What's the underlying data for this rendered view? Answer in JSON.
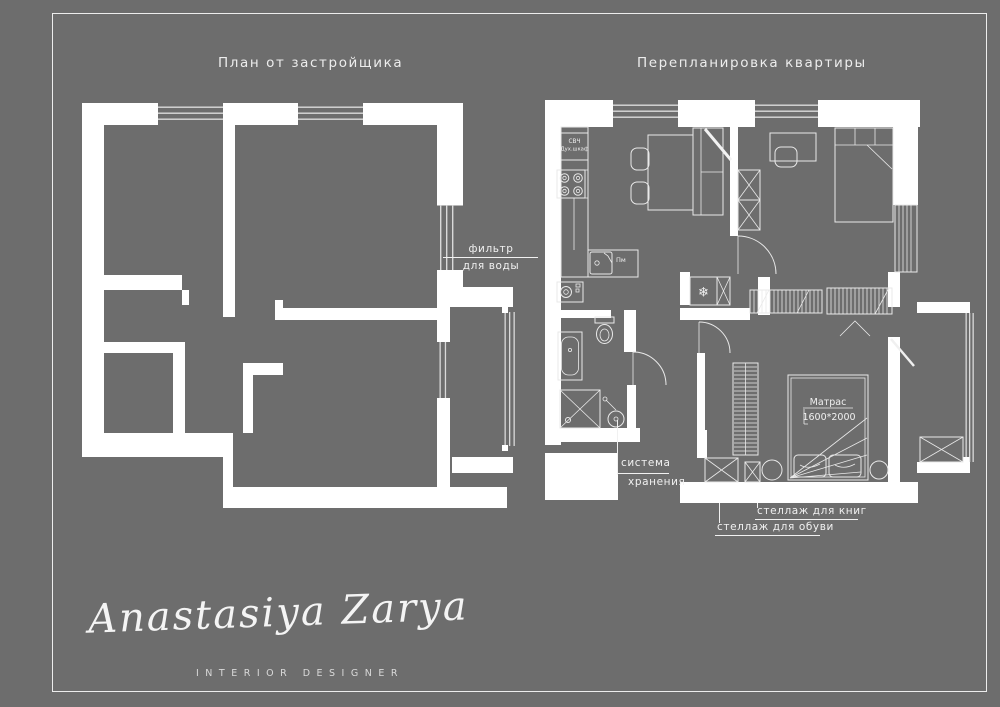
{
  "poster": {
    "background_color": "#6d6d6d",
    "frame_color": "#ededed"
  },
  "titles": {
    "left": "План от застройщика",
    "right": "Перепланировка квартиры"
  },
  "annotations": {
    "water_filter": {
      "line1": "фильтр",
      "line2": "для воды"
    },
    "kitchen_unit": {
      "line1": "СВЧ",
      "line2": "Дух.шкаф"
    },
    "dishwasher": "Пм",
    "fridge_icon": "❄",
    "mattress": {
      "line1": "Матрас",
      "line2": "1600*2000"
    },
    "storage": {
      "line1": "система",
      "line2": "хранения"
    },
    "book_shelf": "стеллаж для книг",
    "shoe_shelf": "стеллаж для обуви"
  },
  "signature": {
    "name": "Anastasiya Zarya",
    "subtitle": "INTERIOR DESIGNER"
  }
}
